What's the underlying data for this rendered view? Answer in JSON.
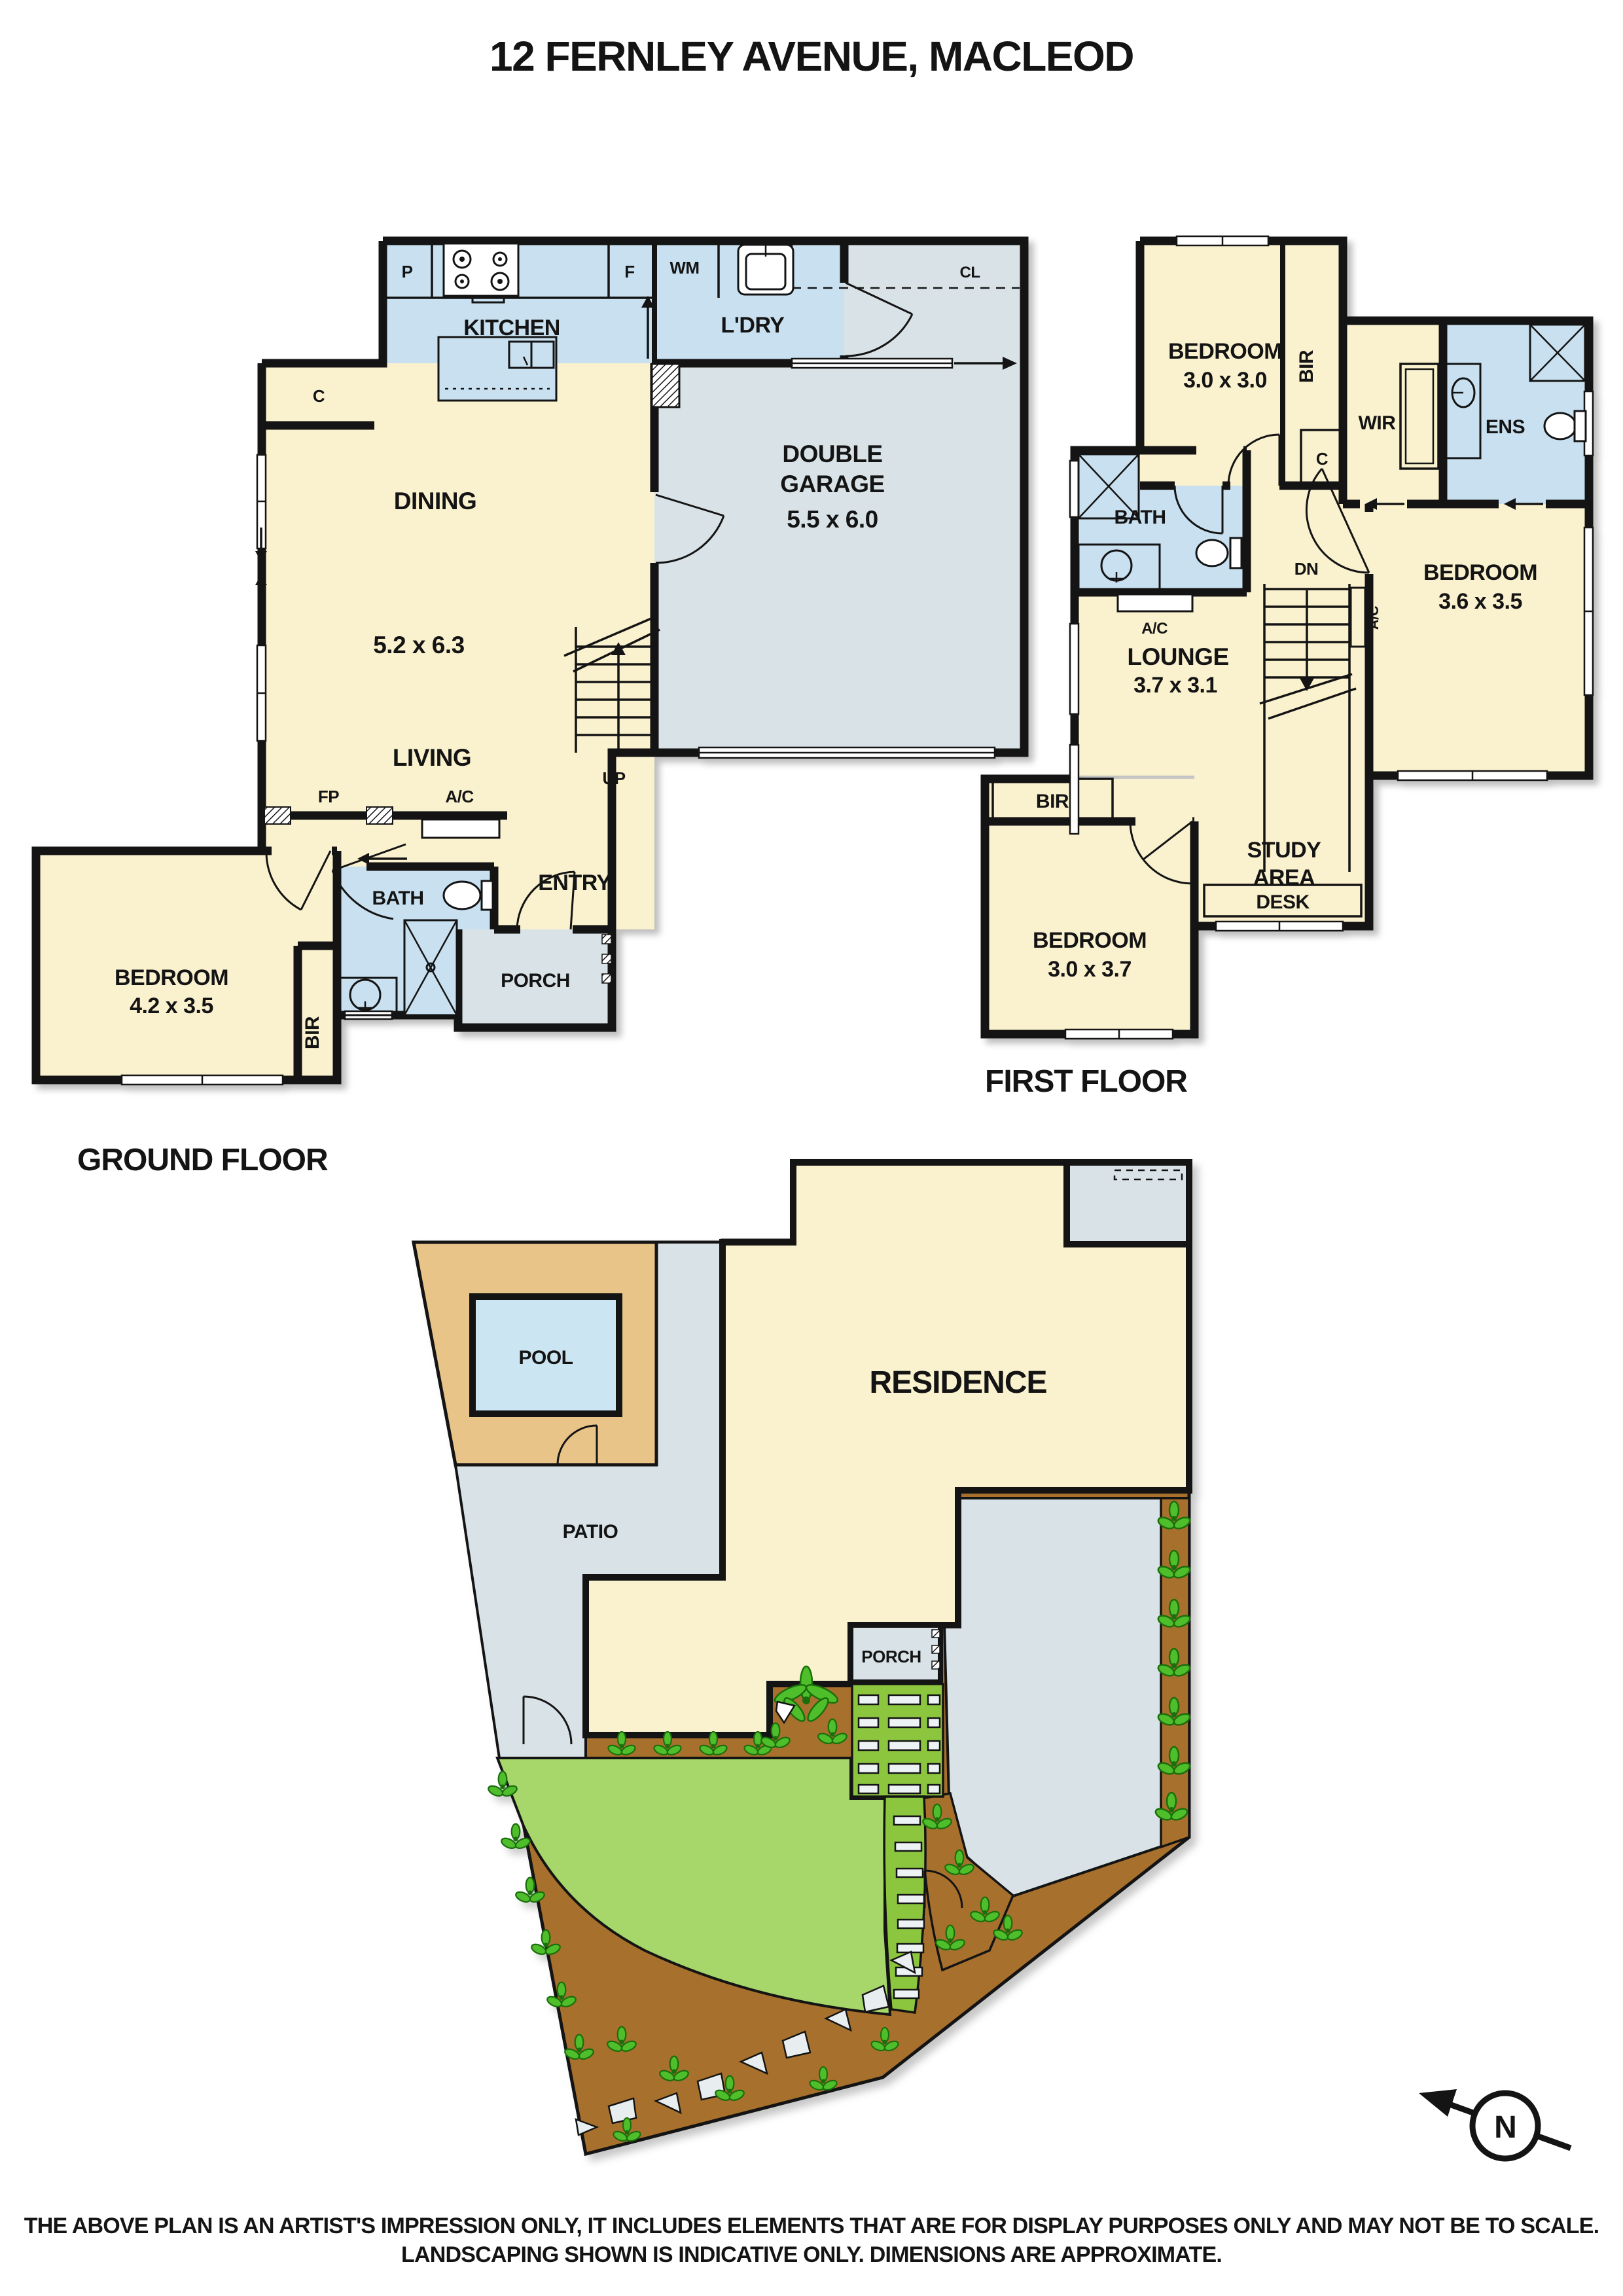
{
  "title": "12 FERNLEY AVENUE, MACLEOD",
  "ground_floor": {
    "label": "GROUND FLOOR",
    "rooms": {
      "kitchen": "KITCHEN",
      "laundry": "L'DRY",
      "dining": "DINING",
      "dining_dim": "5.2 x 6.3",
      "living": "LIVING",
      "garage_line1": "DOUBLE",
      "garage_line2": "GARAGE",
      "garage_dim": "5.5 x 6.0",
      "entry": "ENTRY",
      "bath": "BATH",
      "porch": "PORCH",
      "bedroom": "BEDROOM",
      "bedroom_dim": "4.2 x 3.5"
    },
    "markers": {
      "pantry": "P",
      "fridge": "F",
      "washing_machine": "WM",
      "closet": "CL",
      "cupboard": "C",
      "fireplace": "FP",
      "air_conditioner": "A/C",
      "stairs_up": "UP",
      "built_in_robe": "BIR"
    }
  },
  "first_floor": {
    "label": "FIRST FLOOR",
    "rooms": {
      "bedroom1": "BEDROOM",
      "bedroom1_dim": "3.0 x 3.0",
      "wir": "WIR",
      "ens": "ENS",
      "bath": "BATH",
      "lounge": "LOUNGE",
      "lounge_dim": "3.7 x 3.1",
      "bedroom2": "BEDROOM",
      "bedroom2_dim": "3.6 x 3.5",
      "study_line1": "STUDY",
      "study_line2": "AREA",
      "desk": "DESK",
      "bedroom3": "BEDROOM",
      "bedroom3_dim": "3.0 x 3.7"
    },
    "markers": {
      "bir_top": "BIR",
      "cupboard": "C",
      "stairs_down": "DN",
      "ac_stairs": "A/C",
      "ac_bath": "A/C",
      "bir_bottom": "BIR"
    }
  },
  "site_plan": {
    "residence": "RESIDENCE",
    "pool": "POOL",
    "patio": "PATIO",
    "porch": "PORCH"
  },
  "compass": {
    "north": "N"
  },
  "disclaimer": {
    "line1": "THE ABOVE PLAN IS AN ARTIST'S IMPRESSION ONLY, IT INCLUDES ELEMENTS THAT ARE FOR DISPLAY PURPOSES ONLY AND MAY NOT BE TO SCALE.",
    "line2": "LANDSCAPING SHOWN IS INDICATIVE ONLY. DIMENSIONS ARE APPROXIMATE."
  },
  "colors": {
    "room_cream": "#FAF1CE",
    "wet_blue": "#C8E0F0",
    "hard_gray": "#D9E3E7",
    "wall_black": "#141414",
    "lawn_green": "#A7D66A",
    "path_green": "#8CC63F",
    "garden_brown": "#A8702D",
    "deck_tan": "#E9C489",
    "pool_blue": "#CCE5F2",
    "leaf_green": "#4FBE2B"
  }
}
